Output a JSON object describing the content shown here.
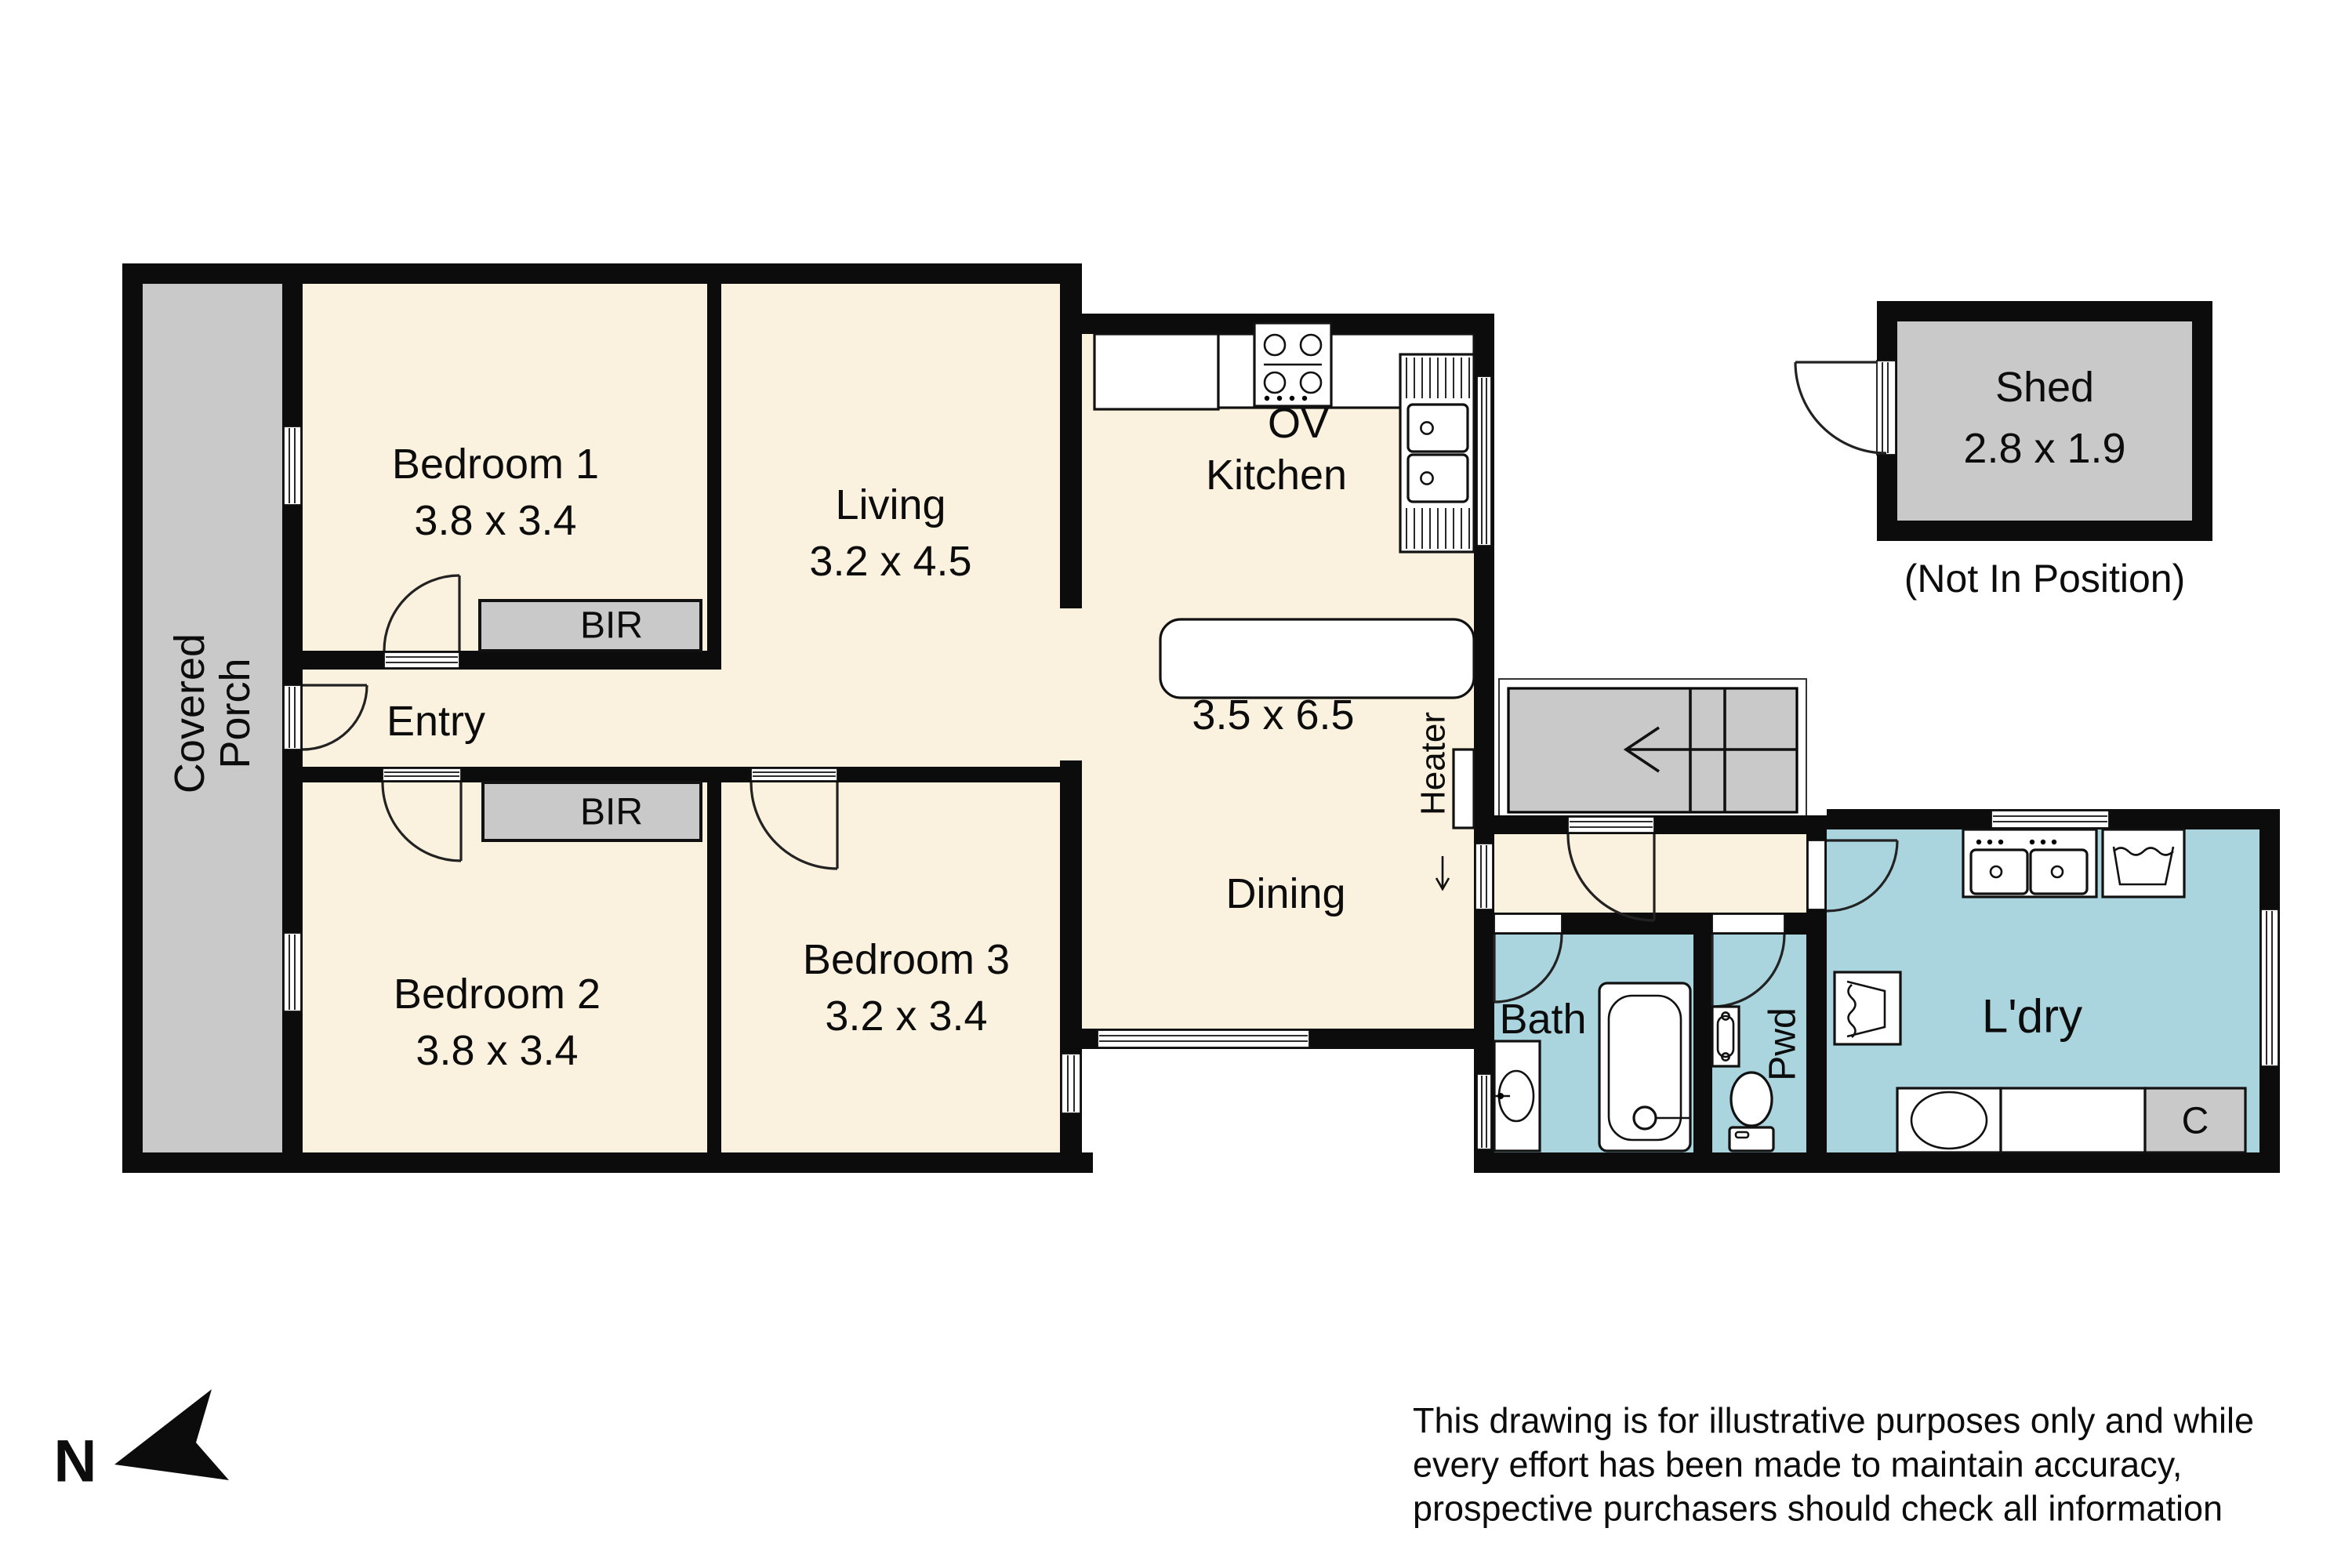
{
  "rooms": {
    "porch": {
      "name_line1": "Covered",
      "name_line2": "Porch"
    },
    "bedroom1": {
      "name": "Bedroom 1",
      "dims": "3.8 x 3.4"
    },
    "bedroom2": {
      "name": "Bedroom 2",
      "dims": "3.8 x 3.4"
    },
    "bedroom3": {
      "name": "Bedroom 3",
      "dims": "3.2 x 3.4"
    },
    "living": {
      "name": "Living",
      "dims": "3.2 x 4.5"
    },
    "kitchen": {
      "name": "Kitchen",
      "oven_label": "OV"
    },
    "dining": {
      "name": "Dining",
      "dims": "3.5 x 6.5"
    },
    "entry": {
      "name": "Entry"
    },
    "bath": {
      "name": "Bath"
    },
    "powder": {
      "name": "Pwd"
    },
    "laundry": {
      "name": "L'dry",
      "cupboard_label": "C"
    },
    "shed": {
      "name": "Shed",
      "dims": "2.8 x 1.9",
      "note": "(Not In Position)"
    },
    "bir_bedroom1": {
      "label": "BIR"
    },
    "bir_bedroom2": {
      "label": "BIR"
    },
    "heater": {
      "label": "Heater"
    }
  },
  "compass": {
    "north_label": "N"
  },
  "disclaimer": {
    "line1": "This drawing is for illustrative purposes only and while",
    "line2": "every effort has been made to maintain accuracy,",
    "line3": "prospective purchasers should check all information"
  },
  "colors": {
    "wall": "#0c0c0c",
    "floor_main": "#faf1de",
    "floor_wet": "#abd5de",
    "floor_gray": "#c9c9c9",
    "background": "#ffffff"
  }
}
